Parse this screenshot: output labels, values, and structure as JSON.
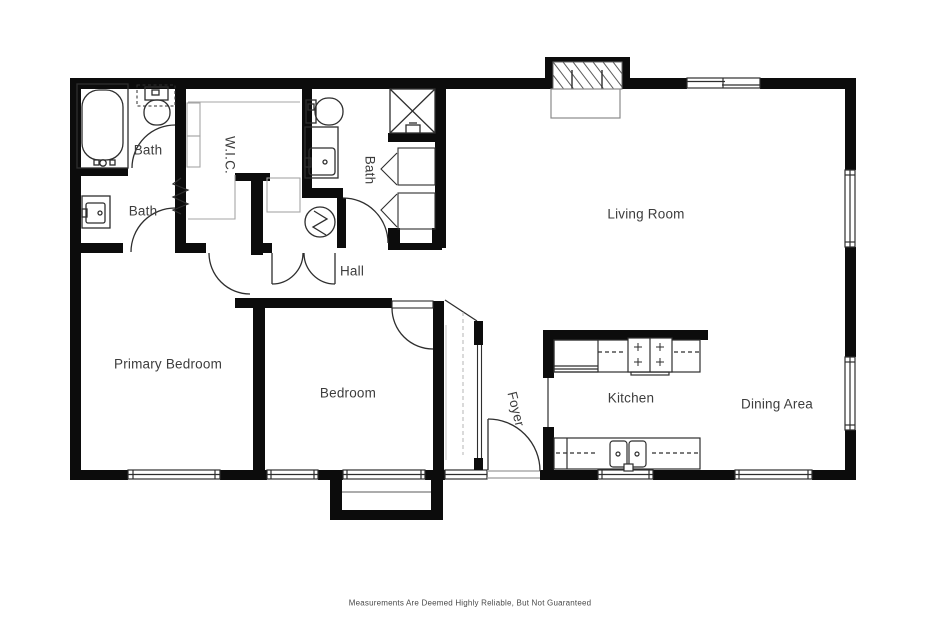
{
  "floorplan": {
    "rooms": [
      {
        "id": "bath-1",
        "label": "Bath"
      },
      {
        "id": "bath-2",
        "label": "Bath"
      },
      {
        "id": "wic",
        "label": "W.I.C."
      },
      {
        "id": "bath-3",
        "label": "Bath"
      },
      {
        "id": "hall",
        "label": "Hall"
      },
      {
        "id": "living-room",
        "label": "Living Room"
      },
      {
        "id": "primary-bedroom",
        "label": "Primary Bedroom"
      },
      {
        "id": "bedroom",
        "label": "Bedroom"
      },
      {
        "id": "foyer",
        "label": "Foyer"
      },
      {
        "id": "kitchen",
        "label": "Kitchen"
      },
      {
        "id": "dining-area",
        "label": "Dining Area"
      }
    ],
    "disclaimer": "Measurements Are Deemed Highly Reliable, But Not Guaranteed",
    "icons": [
      "bathtub-icon",
      "toilet-icon",
      "sink-icon",
      "shower-icon",
      "water-heater-icon",
      "fireplace-icon",
      "range-icon",
      "refrigerator-icon",
      "kitchen-sink-icon",
      "door-arc",
      "window",
      "sliding-door",
      "closet-shelves",
      "porch-steps"
    ],
    "colors": {
      "wall": "#0c0c0c",
      "fixture_line": "#2e2e2e",
      "light_line": "#a6a6a6",
      "label_text": "#3d3d3d",
      "background": "#ffffff"
    }
  }
}
